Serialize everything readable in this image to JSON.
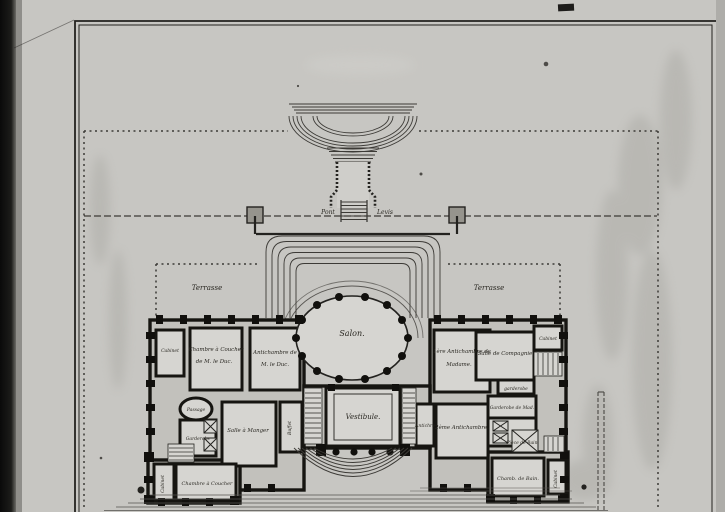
{
  "plan": {
    "forecourt": {
      "pont": "Pont",
      "levis": "Levis"
    },
    "terrace_left": "Terrasse",
    "terrace_right": "Terrasse",
    "rooms": {
      "salon": "Salon.",
      "vestibule": "Vestibule.",
      "cabinet_w": "Cabinet",
      "chambre_duc_l1": "Chambre à Coucher",
      "chambre_duc_l2": "de M. le Duc.",
      "antichambre_duc_l1": "Antichambre de",
      "antichambre_duc_l2": "M. le Duc.",
      "passage": "Passage",
      "garderobe_w": "Garderobe",
      "salle_a_manger": "Salle à Manger",
      "buffet": "Buffet",
      "chambre_coucher_sw": "Chambre à Coucher",
      "cabinet_sw": "Cabinet",
      "antichambre_madame_l1": "1ère Antichambre de",
      "antichambre_madame_l2": "Madame.",
      "salle_de_compagnie": "Salle de Compagnie",
      "cabinet_ne": "Cabinet",
      "garderobe_e": "garderobe",
      "garderobe_madame": "Garderobe de Mad.",
      "piece_bain": "Pièce de Bain",
      "deuxieme_antichambre": "2ème Antichambre.",
      "antichre": "Antichre",
      "chambre_bain_se": "Chamb. de Bain.",
      "cabinet_se": "Cabinet"
    }
  }
}
